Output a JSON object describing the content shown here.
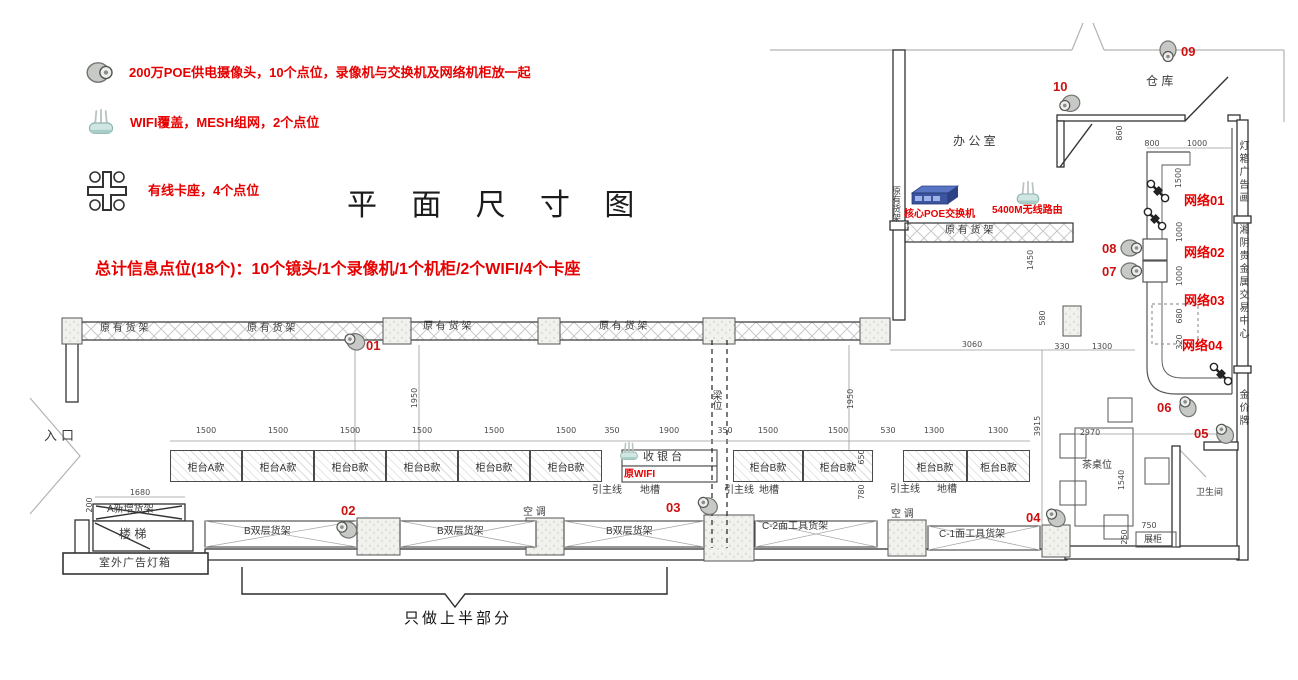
{
  "colors": {
    "red": "#e60000",
    "wall": "#333333",
    "dim_text": "#4a4a4a",
    "switch_blue": "#3b55a0",
    "router_teal": "#cfe6e2",
    "camera_gray": "#c6c9c6"
  },
  "title": "平 面 尺 寸 图",
  "summary": "总计信息点位(18个)：10个镜头/1个录像机/1个机柜/2个WIFI/4个卡座",
  "bottom_note": "只做上半部分",
  "legend": {
    "items": [
      {
        "icon": "dome-camera-icon",
        "text": "200万POE供电摄像头，10个点位，录像机与交换机及网络机柜放一起"
      },
      {
        "icon": "wifi-router-icon",
        "text": "WIFI覆盖，MESH组网，2个点位"
      },
      {
        "icon": "card-seat-icon",
        "text": "有线卡座，4个点位"
      }
    ]
  },
  "plan": {
    "room_labels": [
      {
        "t": "办 公 室",
        "x": 953,
        "y": 135,
        "s": 12
      },
      {
        "t": "仓 库",
        "x": 1146,
        "y": 75,
        "s": 12
      },
      {
        "t": "入口",
        "x": 44,
        "y": 429,
        "s": 13,
        "ls": 4
      },
      {
        "t": "楼 梯",
        "x": 119,
        "y": 528,
        "s": 12
      },
      {
        "t": "A新增货架",
        "x": 107,
        "y": 505,
        "s": 10
      },
      {
        "t": "室外广告灯箱",
        "x": 99,
        "y": 558,
        "s": 11,
        "ls": 1
      },
      {
        "t": "原 有 货 架",
        "x": 100,
        "y": 324,
        "s": 10
      },
      {
        "t": "原 有 货 架",
        "x": 247,
        "y": 324,
        "s": 10
      },
      {
        "t": "原 有 货 架",
        "x": 423,
        "y": 322,
        "s": 10
      },
      {
        "t": "原 有 货 架",
        "x": 599,
        "y": 322,
        "s": 10
      },
      {
        "t": "原 有 货 架",
        "x": 945,
        "y": 226,
        "s": 10
      },
      {
        "t": "原有货架",
        "x": 891,
        "y": 186,
        "s": 9,
        "vert": true
      },
      {
        "t": "收 银 台",
        "x": 643,
        "y": 452,
        "s": 11
      },
      {
        "t": "B双层货架",
        "x": 244,
        "y": 527,
        "s": 10
      },
      {
        "t": "B双层货架",
        "x": 437,
        "y": 527,
        "s": 10
      },
      {
        "t": "B双层货架",
        "x": 606,
        "y": 527,
        "s": 10
      },
      {
        "t": "C-2面工具货架",
        "x": 762,
        "y": 522,
        "s": 10
      },
      {
        "t": "C-1面工具货架",
        "x": 939,
        "y": 530,
        "s": 10
      },
      {
        "t": "空 调",
        "x": 523,
        "y": 508,
        "s": 10
      },
      {
        "t": "空 调",
        "x": 891,
        "y": 510,
        "s": 10
      },
      {
        "t": "引主线",
        "x": 592,
        "y": 486,
        "s": 10
      },
      {
        "t": "引主线",
        "x": 724,
        "y": 486,
        "s": 10
      },
      {
        "t": "引主线",
        "x": 890,
        "y": 485,
        "s": 10
      },
      {
        "t": "地槽",
        "x": 640,
        "y": 486,
        "s": 10
      },
      {
        "t": "地槽",
        "x": 759,
        "y": 486,
        "s": 10
      },
      {
        "t": "地槽",
        "x": 937,
        "y": 485,
        "s": 10
      },
      {
        "t": "茶桌位",
        "x": 1082,
        "y": 461,
        "s": 10
      },
      {
        "t": "卫生间",
        "x": 1196,
        "y": 488,
        "s": 9
      },
      {
        "t": "展柜",
        "x": 1144,
        "y": 535,
        "s": 9
      },
      {
        "t": "梁位",
        "x": 710,
        "y": 390,
        "s": 10,
        "vert": true
      }
    ],
    "side_texts": [
      {
        "t": "灯箱广告画",
        "x": 1237,
        "y": 140
      },
      {
        "t": "湘阴贵金属交易中心",
        "x": 1237,
        "y": 224
      },
      {
        "t": "金价牌",
        "x": 1237,
        "y": 389
      }
    ],
    "counters": [
      {
        "t": "柜台A款",
        "x": 170,
        "w": 72
      },
      {
        "t": "柜台A款",
        "x": 242,
        "w": 72
      },
      {
        "t": "柜台B款",
        "x": 314,
        "w": 72
      },
      {
        "t": "柜台B款",
        "x": 386,
        "w": 72
      },
      {
        "t": "柜台B款",
        "x": 458,
        "w": 72
      },
      {
        "t": "柜台B款",
        "x": 530,
        "w": 72
      },
      {
        "t": "柜台B款",
        "x": 733,
        "w": 70
      },
      {
        "t": "柜台B款",
        "x": 803,
        "w": 70
      },
      {
        "t": "柜台B款",
        "x": 903,
        "w": 64
      },
      {
        "t": "柜台B款",
        "x": 967,
        "w": 63
      }
    ],
    "network_labels": [
      {
        "t": "网络01",
        "x": 1184,
        "y": 194
      },
      {
        "t": "网络02",
        "x": 1184,
        "y": 246
      },
      {
        "t": "网络03",
        "x": 1184,
        "y": 294
      },
      {
        "t": "网络04",
        "x": 1182,
        "y": 339
      }
    ],
    "device_labels": [
      {
        "t": "核心POE交换机",
        "x": 904,
        "y": 210,
        "s": 10
      },
      {
        "t": "5400M无线路由",
        "x": 992,
        "y": 206,
        "s": 10
      },
      {
        "t": "原WIFI",
        "x": 624,
        "y": 470,
        "s": 10
      }
    ],
    "devices": [
      {
        "type": "poe-switch",
        "x": 906,
        "y": 184
      },
      {
        "type": "wifi-router",
        "x": 1014,
        "y": 180
      },
      {
        "type": "wifi-router-small",
        "x": 618,
        "y": 441
      }
    ],
    "cameras": [
      {
        "id": "01",
        "ix": 342,
        "iy": 331,
        "rot": 205,
        "lx": 366,
        "ly": 339
      },
      {
        "id": "02",
        "ix": 334,
        "iy": 519,
        "rot": 205,
        "lx": 341,
        "ly": 504
      },
      {
        "id": "03",
        "ix": 695,
        "iy": 495,
        "rot": 215,
        "lx": 666,
        "ly": 501
      },
      {
        "id": "04",
        "ix": 1043,
        "iy": 507,
        "rot": 220,
        "lx": 1026,
        "ly": 511
      },
      {
        "id": "05",
        "ix": 1212,
        "iy": 423,
        "rot": 235,
        "lx": 1194,
        "ly": 427
      },
      {
        "id": "06",
        "ix": 1175,
        "iy": 396,
        "rot": 245,
        "lx": 1157,
        "ly": 401
      },
      {
        "id": "07",
        "ix": 1120,
        "iy": 261,
        "rot": 0,
        "lx": 1102,
        "ly": 265
      },
      {
        "id": "08",
        "ix": 1120,
        "iy": 238,
        "rot": 0,
        "lx": 1102,
        "ly": 242
      },
      {
        "id": "09",
        "ix": 1156,
        "iy": 42,
        "rot": 90,
        "lx": 1181,
        "ly": 45
      },
      {
        "id": "10",
        "ix": 1057,
        "iy": 94,
        "rot": 160,
        "lx": 1053,
        "ly": 80
      }
    ],
    "card_seats": [
      {
        "x": 1143,
        "y": 184,
        "rot": 45
      },
      {
        "x": 1140,
        "y": 212,
        "rot": 45
      },
      {
        "x": 1206,
        "y": 367,
        "rot": 45
      }
    ],
    "dims": [
      {
        "t": "1500",
        "x": 206,
        "y": 427
      },
      {
        "t": "1500",
        "x": 278,
        "y": 427
      },
      {
        "t": "1500",
        "x": 350,
        "y": 427
      },
      {
        "t": "1500",
        "x": 422,
        "y": 427
      },
      {
        "t": "1500",
        "x": 494,
        "y": 427
      },
      {
        "t": "1500",
        "x": 566,
        "y": 427
      },
      {
        "t": "350",
        "x": 612,
        "y": 427
      },
      {
        "t": "1900",
        "x": 669,
        "y": 427
      },
      {
        "t": "350",
        "x": 725,
        "y": 427
      },
      {
        "t": "1500",
        "x": 768,
        "y": 427
      },
      {
        "t": "1500",
        "x": 838,
        "y": 427
      },
      {
        "t": "530",
        "x": 888,
        "y": 427
      },
      {
        "t": "1300",
        "x": 934,
        "y": 427
      },
      {
        "t": "1300",
        "x": 998,
        "y": 427
      },
      {
        "t": "1680",
        "x": 140,
        "y": 489
      },
      {
        "t": "200",
        "x": 90,
        "y": 505,
        "v": true
      },
      {
        "t": "1950",
        "x": 415,
        "y": 398,
        "v": true
      },
      {
        "t": "1950",
        "x": 851,
        "y": 399,
        "v": true
      },
      {
        "t": "3060",
        "x": 972,
        "y": 341
      },
      {
        "t": "330",
        "x": 1062,
        "y": 343
      },
      {
        "t": "1300",
        "x": 1102,
        "y": 343
      },
      {
        "t": "1450",
        "x": 1031,
        "y": 260,
        "v": true
      },
      {
        "t": "580",
        "x": 1043,
        "y": 318,
        "v": true
      },
      {
        "t": "860",
        "x": 1120,
        "y": 133,
        "v": true
      },
      {
        "t": "800",
        "x": 1152,
        "y": 140
      },
      {
        "t": "1000",
        "x": 1197,
        "y": 140
      },
      {
        "t": "1500",
        "x": 1179,
        "y": 178,
        "v": true
      },
      {
        "t": "1000",
        "x": 1180,
        "y": 232,
        "v": true
      },
      {
        "t": "1000",
        "x": 1180,
        "y": 276,
        "v": true
      },
      {
        "t": "680",
        "x": 1180,
        "y": 316,
        "v": true
      },
      {
        "t": "320",
        "x": 1180,
        "y": 342,
        "v": true
      },
      {
        "t": "3915",
        "x": 1038,
        "y": 426,
        "v": true
      },
      {
        "t": "2970",
        "x": 1090,
        "y": 429
      },
      {
        "t": "1540",
        "x": 1122,
        "y": 480,
        "v": true
      },
      {
        "t": "750",
        "x": 1149,
        "y": 522
      },
      {
        "t": "250",
        "x": 1125,
        "y": 537,
        "v": true
      },
      {
        "t": "650",
        "x": 862,
        "y": 457,
        "v": true
      },
      {
        "t": "780",
        "x": 862,
        "y": 492,
        "v": true
      }
    ]
  }
}
